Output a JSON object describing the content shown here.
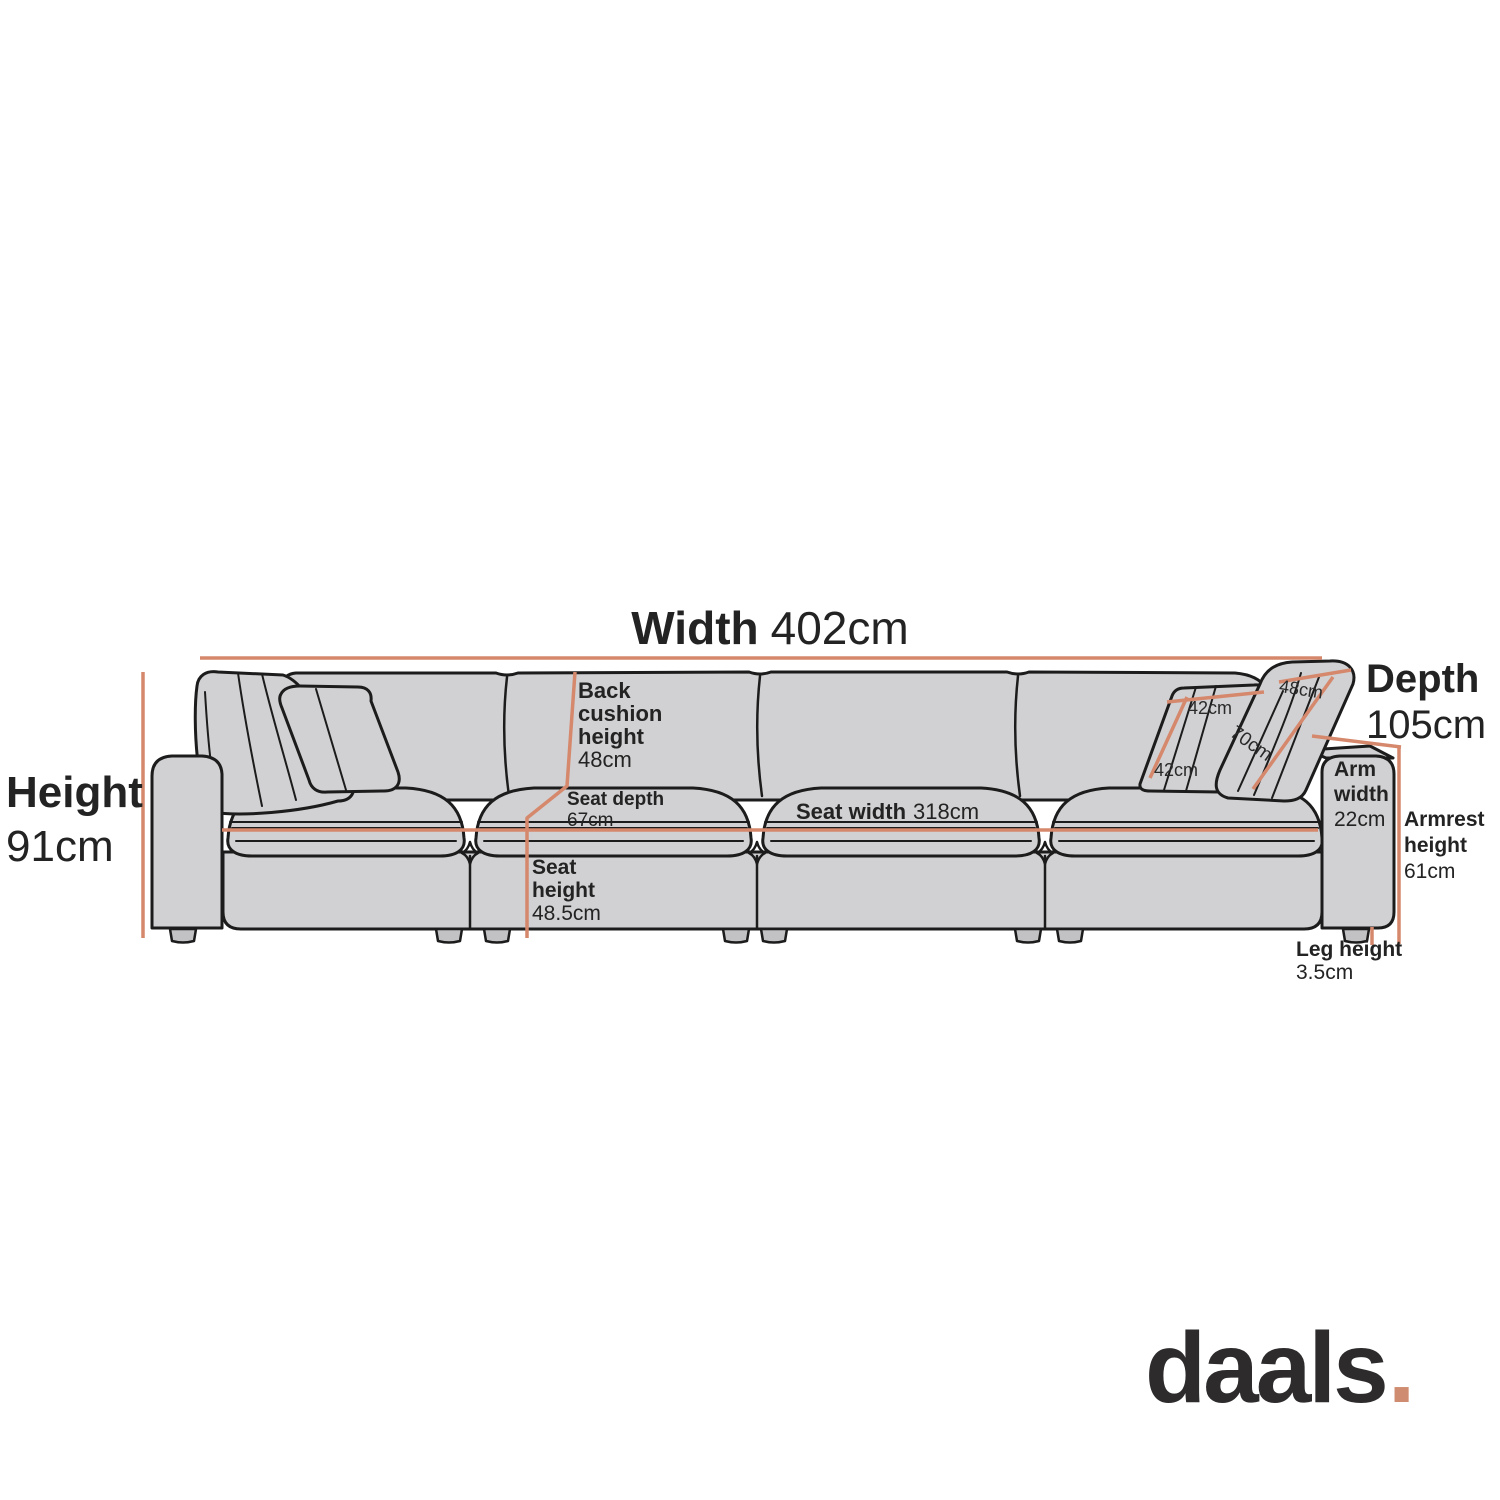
{
  "title": "Sofa dimensions diagram",
  "colors": {
    "background": "#FFFFFF",
    "accent_orange": "#D5886C",
    "sofa_fill": "#D1D1D3",
    "outline": "#1C1C1C",
    "text": "#232323",
    "logo_text": "#2D2B2C",
    "logo_dot": "#CF8C70"
  },
  "labels": {
    "width": {
      "name": "Width",
      "value": "402cm"
    },
    "height": {
      "name": "Height",
      "value": "91cm"
    },
    "depth": {
      "name": "Depth",
      "value": "105cm"
    },
    "back_cushion_height": {
      "line1": "Back",
      "line2": "cushion",
      "line3": "height",
      "value": "48cm"
    },
    "seat_depth": {
      "name": "Seat depth",
      "value": "67cm"
    },
    "seat_width": {
      "name": "Seat width",
      "value": "318cm"
    },
    "seat_height": {
      "line1": "Seat",
      "line2": "height",
      "value": "48.5cm"
    },
    "arm_width": {
      "line1": "Arm",
      "line2": "width",
      "value": "22cm"
    },
    "armrest_height": {
      "line1": "Armrest",
      "line2": "height",
      "value": "61cm"
    },
    "leg_height": {
      "name": "Leg height",
      "value": "3.5cm"
    },
    "cushion_inner_top": "42cm",
    "cushion_inner_side": "42cm",
    "cushion_outer_face": "70cm",
    "cushion_outer_top": "48cm"
  },
  "logo": {
    "text": "daals",
    "dot": "."
  }
}
